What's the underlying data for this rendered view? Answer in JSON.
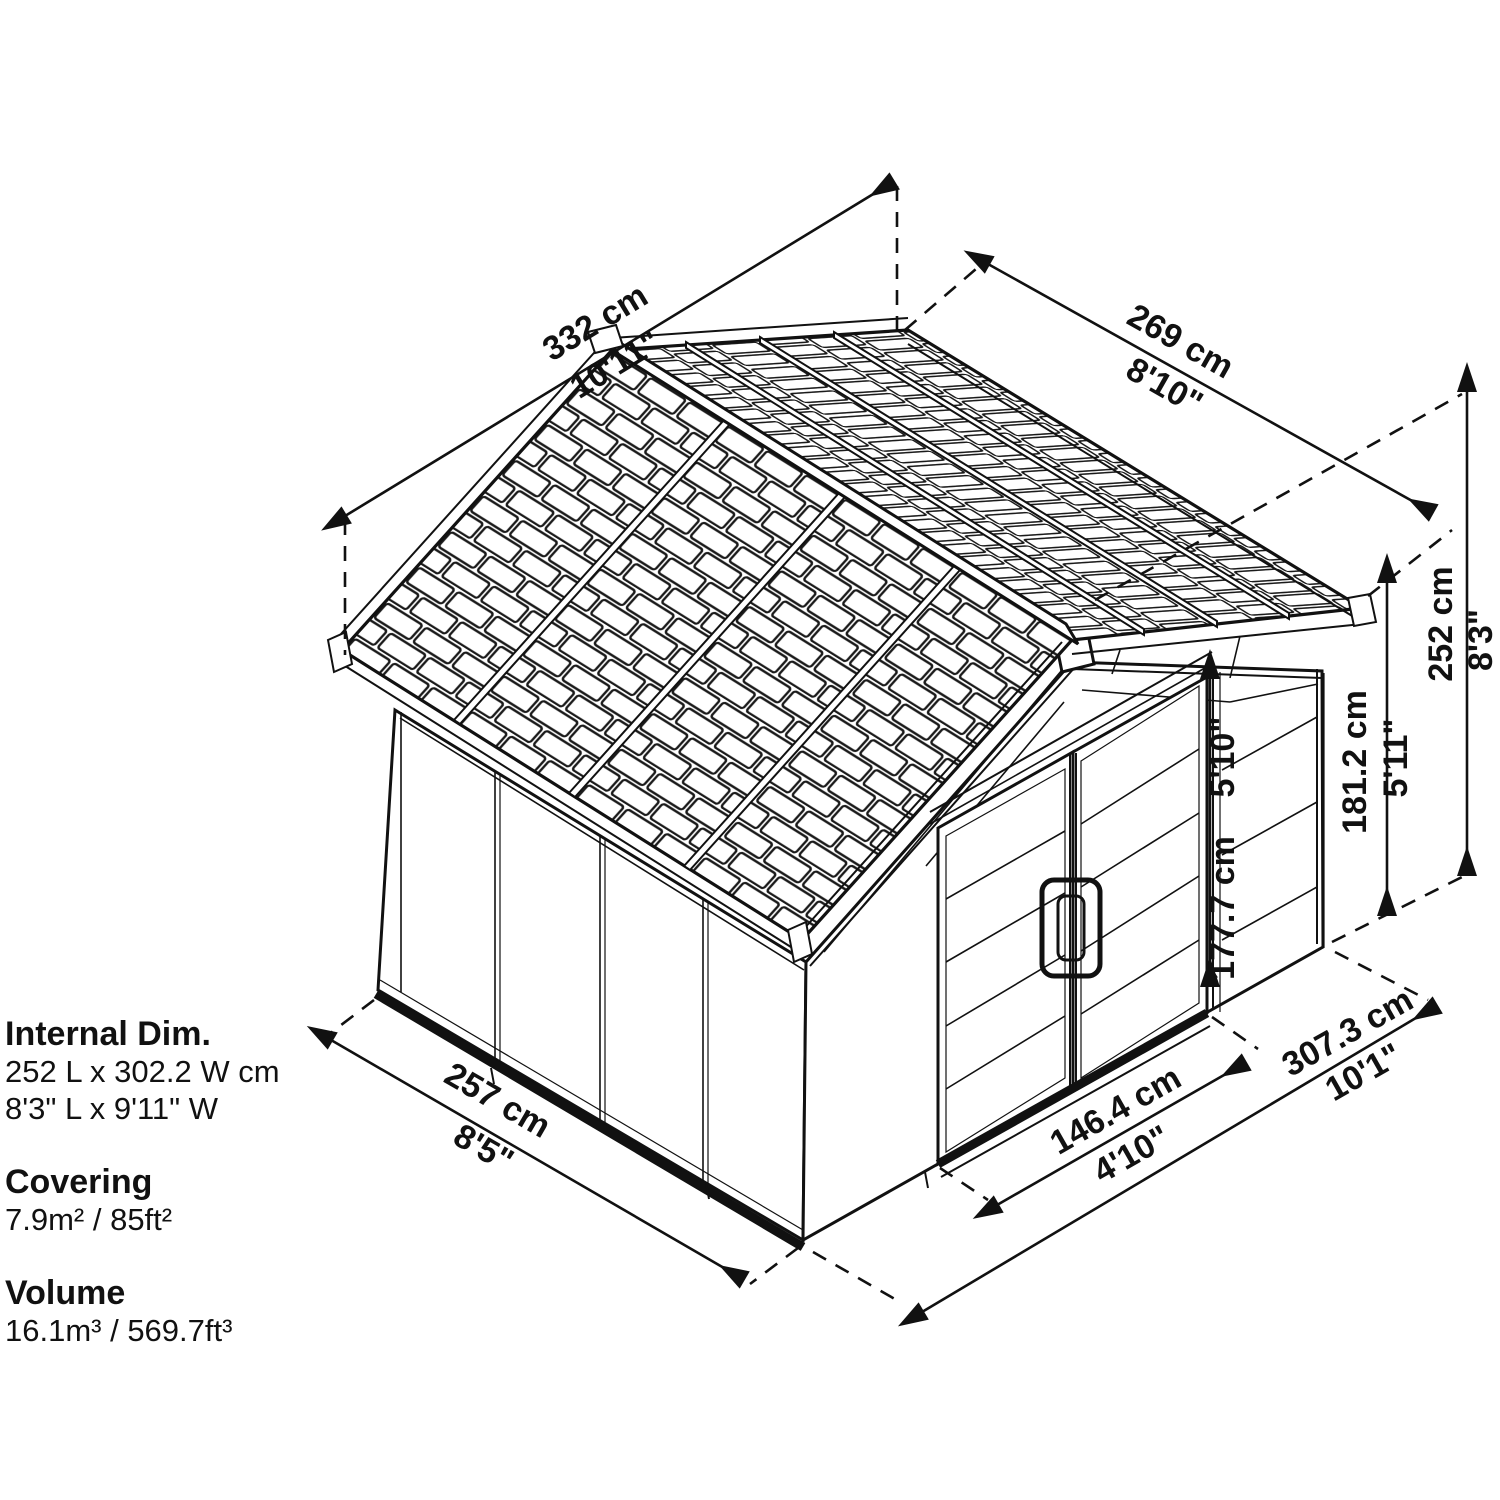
{
  "title": "Shed dimension diagram",
  "colors": {
    "line": "#111111",
    "background": "#ffffff"
  },
  "panel": {
    "internal": {
      "label": "Internal Dim.",
      "metric": "252 L x 302.2 W cm",
      "imperial": "8'3\" L x 9'11\" W"
    },
    "covering": {
      "label": "Covering",
      "value": "7.9m² / 85ft²"
    },
    "volume": {
      "label": "Volume",
      "value": "16.1m³ / 569.7ft³"
    }
  },
  "dimensions": {
    "roof_depth": {
      "metric": "332 cm",
      "imperial": "10'11\""
    },
    "roof_width": {
      "metric": "269 cm",
      "imperial": "8'10\""
    },
    "total_height": {
      "metric": "252 cm",
      "imperial": "8'3\""
    },
    "wall_height": {
      "metric": "181.2 cm",
      "imperial": "5'11\""
    },
    "door_height": {
      "metric": "177.7 cm",
      "imperial": "5'10\""
    },
    "door_width": {
      "metric": "146.4 cm",
      "imperial": "4'10\""
    },
    "side_depth": {
      "metric": "257 cm",
      "imperial": "8'5\""
    },
    "front_width": {
      "metric": "307.3 cm",
      "imperial": "10'1\""
    }
  }
}
